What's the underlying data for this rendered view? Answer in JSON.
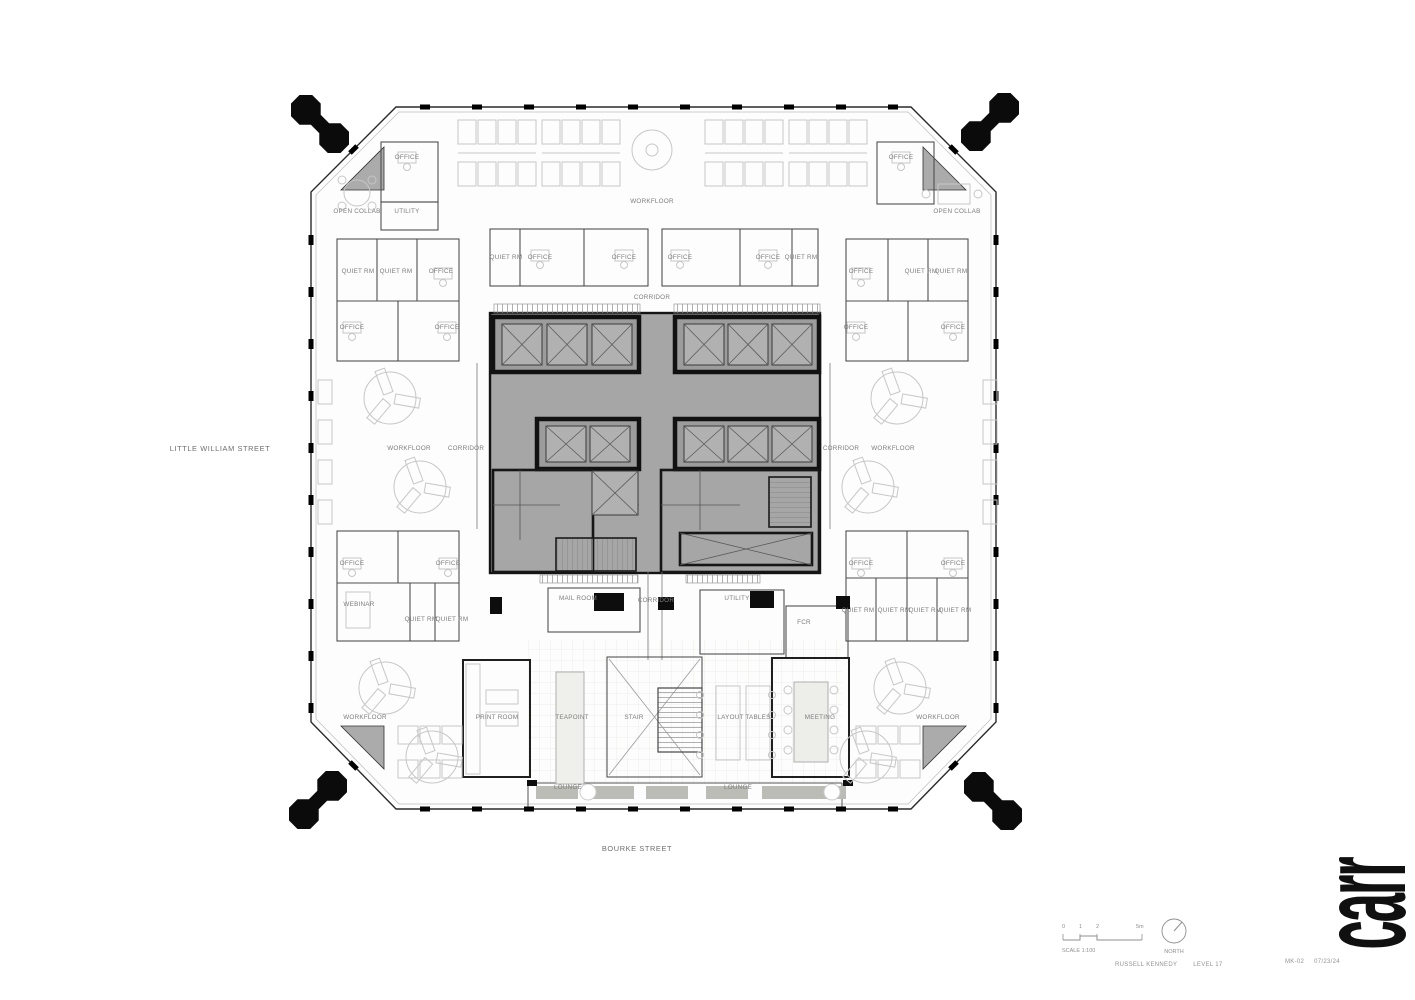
{
  "sheet": {
    "firm_logo": "carr"
  },
  "title_block": {
    "scale_ticks": [
      "0",
      "1",
      "2",
      "5m"
    ],
    "scale_label": "SCALE 1:100",
    "north_label": "NORTH",
    "client": "RUSSELL KENNEDY",
    "level": "LEVEL 17",
    "drawing_no": "MK-02",
    "date": "07/23/24"
  },
  "colors": {
    "wall": "#141414",
    "core_fill": "#a6a6a6",
    "corner_fill": "#ababab",
    "label": "#7c7c7c",
    "furniture": "#c7c7c7"
  },
  "plan": {
    "labels": [
      {
        "text": "OFFICE",
        "x": 407,
        "y": 159
      },
      {
        "text": "UTILITY",
        "x": 407,
        "y": 213
      },
      {
        "text": "OPEN COLLAB",
        "x": 357,
        "y": 213
      },
      {
        "text": "WORKFLOOR",
        "x": 652,
        "y": 203
      },
      {
        "text": "OFFICE",
        "x": 901,
        "y": 159
      },
      {
        "text": "OPEN COLLAB",
        "x": 957,
        "y": 213
      },
      {
        "text": "QUIET RM",
        "x": 358,
        "y": 273
      },
      {
        "text": "QUIET RM",
        "x": 396,
        "y": 273
      },
      {
        "text": "OFFICE",
        "x": 441,
        "y": 273
      },
      {
        "text": "OFFICE",
        "x": 352,
        "y": 329
      },
      {
        "text": "OFFICE",
        "x": 447,
        "y": 329
      },
      {
        "text": "QUIET RM",
        "x": 506,
        "y": 259
      },
      {
        "text": "OFFICE",
        "x": 540,
        "y": 259
      },
      {
        "text": "OFFICE",
        "x": 624,
        "y": 259
      },
      {
        "text": "OFFICE",
        "x": 680,
        "y": 259
      },
      {
        "text": "OFFICE",
        "x": 768,
        "y": 259
      },
      {
        "text": "QUIET RM",
        "x": 801,
        "y": 259
      },
      {
        "text": "OFFICE",
        "x": 861,
        "y": 273
      },
      {
        "text": "QUIET RM",
        "x": 921,
        "y": 273
      },
      {
        "text": "QUIET RM",
        "x": 951,
        "y": 273
      },
      {
        "text": "OFFICE",
        "x": 856,
        "y": 329
      },
      {
        "text": "OFFICE",
        "x": 953,
        "y": 329
      },
      {
        "text": "CORRIDOR",
        "x": 652,
        "y": 299
      },
      {
        "text": "WORKFLOOR",
        "x": 409,
        "y": 450
      },
      {
        "text": "CORRIDOR",
        "x": 466,
        "y": 450
      },
      {
        "text": "CORRIDOR",
        "x": 841,
        "y": 450
      },
      {
        "text": "WORKFLOOR",
        "x": 893,
        "y": 450
      },
      {
        "text": "OFFICE",
        "x": 352,
        "y": 565
      },
      {
        "text": "OFFICE",
        "x": 448,
        "y": 565
      },
      {
        "text": "WEBINAR",
        "x": 359,
        "y": 606
      },
      {
        "text": "QUIET RM",
        "x": 421,
        "y": 621
      },
      {
        "text": "QUIET RM",
        "x": 452,
        "y": 621
      },
      {
        "text": "OFFICE",
        "x": 861,
        "y": 565
      },
      {
        "text": "OFFICE",
        "x": 953,
        "y": 565
      },
      {
        "text": "QUIET RM",
        "x": 858,
        "y": 612
      },
      {
        "text": "QUIET RM",
        "x": 894,
        "y": 612
      },
      {
        "text": "QUIET RM",
        "x": 925,
        "y": 612
      },
      {
        "text": "QUIET RM",
        "x": 955,
        "y": 612
      },
      {
        "text": "MAIL ROOM",
        "x": 578,
        "y": 600
      },
      {
        "text": "CORRIDOR",
        "x": 656,
        "y": 602
      },
      {
        "text": "UTILITY",
        "x": 737,
        "y": 600
      },
      {
        "text": "FCR",
        "x": 804,
        "y": 624
      },
      {
        "text": "WORKFLOOR",
        "x": 365,
        "y": 719
      },
      {
        "text": "PRINT ROOM",
        "x": 497,
        "y": 719
      },
      {
        "text": "TEAPOINT",
        "x": 572,
        "y": 719
      },
      {
        "text": "STAIR",
        "x": 634,
        "y": 719
      },
      {
        "text": "LAYOUT TABLES",
        "x": 744,
        "y": 719
      },
      {
        "text": "MEETING",
        "x": 820,
        "y": 719
      },
      {
        "text": "WORKFLOOR",
        "x": 938,
        "y": 719
      },
      {
        "text": "LOUNGE",
        "x": 568,
        "y": 789
      },
      {
        "text": "LOUNGE",
        "x": 738,
        "y": 789
      },
      {
        "text": "LITTLE WILLIAM STREET",
        "x": 220,
        "y": 451,
        "kind": "street"
      },
      {
        "text": "BOURKE STREET",
        "x": 637,
        "y": 851,
        "kind": "street"
      }
    ]
  }
}
